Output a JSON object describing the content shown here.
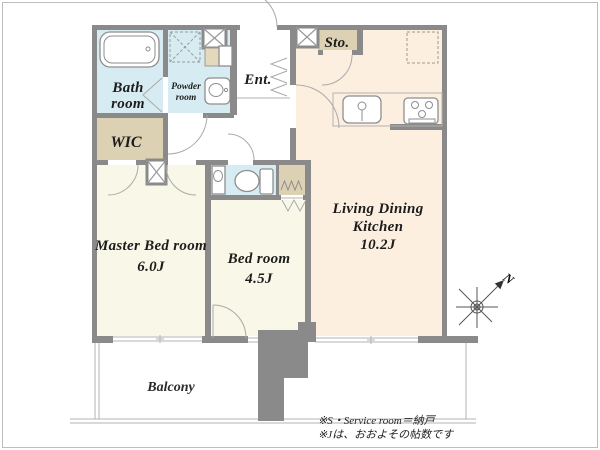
{
  "rooms": {
    "bath": {
      "line1": "Bath",
      "line2": "room"
    },
    "powder": {
      "line1": "Powder",
      "line2": "room"
    },
    "wic": {
      "label": "WIC"
    },
    "entrance": {
      "label": "Ent."
    },
    "storage": {
      "label": "Sto."
    },
    "ldk": {
      "line1": "Living Dining",
      "line2": "Kitchen",
      "size": "10.2J"
    },
    "master_bedroom": {
      "label": "Master Bed room",
      "size": "6.0J"
    },
    "bedroom": {
      "label": "Bed room",
      "size": "4.5J"
    },
    "balcony": {
      "label": "Balcony"
    }
  },
  "compass": {
    "north_label": "N"
  },
  "notes": {
    "line1": "※S・Service room＝納戸",
    "line2": "※Jは、おおよその帖数です"
  },
  "colors": {
    "wall": "#8a8a8a",
    "wet_room_floor": "#d7ecf2",
    "storage_floor": "#ddd1b3",
    "ldk_floor": "#fcefe0",
    "bedroom_floor": "#f8f7e8",
    "balcony_floor": "#ffffff",
    "shelf_tan": "#e5d8bd"
  }
}
